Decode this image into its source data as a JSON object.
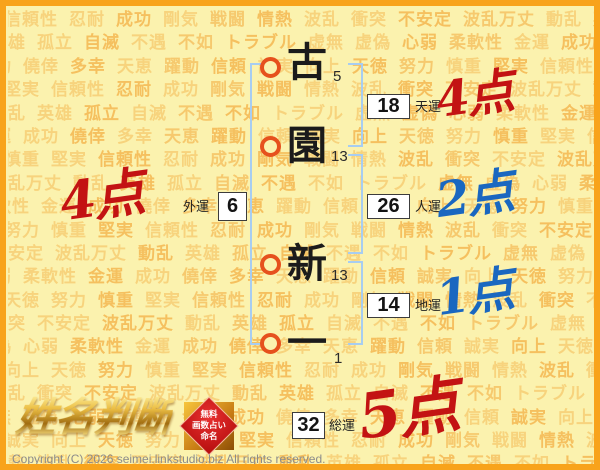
{
  "page": {
    "logo_text": "姓名判断",
    "copyright": "Copyright (C) 2026 seimei.linkstudio.biz All rights reserved.",
    "badge": {
      "line1": "無料",
      "line2": "画数占い",
      "line3": "命名"
    }
  },
  "name": {
    "characters": [
      {
        "char": "古",
        "strokes": "5"
      },
      {
        "char": "園",
        "strokes": "13"
      },
      {
        "char": "新",
        "strokes": "13"
      },
      {
        "char": "一",
        "strokes": "1"
      }
    ]
  },
  "fortunes": [
    {
      "id": "tenun",
      "label": "天運",
      "value": "18",
      "score": "4点",
      "score_color": "#c31313"
    },
    {
      "id": "jinun",
      "label": "人運",
      "value": "26",
      "score": "2点",
      "score_color": "#1a67c0"
    },
    {
      "id": "chiun",
      "label": "地運",
      "value": "14",
      "score": "1点",
      "score_color": "#1a67c0"
    },
    {
      "id": "gaiun",
      "label": "外運",
      "value": "6",
      "score": "4点",
      "score_color": "#c31313"
    },
    {
      "id": "souun",
      "label": "総運",
      "value": "32",
      "score": "5点",
      "score_color": "#c31313"
    }
  ],
  "colors": {
    "border": "#f8a31b",
    "background": "#fbf2ae",
    "watermark_word": "#f3a93a",
    "bracket_blue": "#a7cdf1",
    "circle_red": "#e6511d",
    "score_red": "#c31313",
    "score_blue": "#1a67c0"
  },
  "background_words": [
    "信頼性",
    "忍耐",
    "成功",
    "剛気",
    "戦闘",
    "情熱",
    "波乱",
    "衝突",
    "不安定",
    "波乱万丈",
    "動乱",
    "英雄",
    "孤立",
    "自滅",
    "不遇",
    "不如",
    "トラブル",
    "虚無",
    "虚偽",
    "心弱",
    "柔軟性",
    "金運",
    "成功",
    "僥倖",
    "多幸",
    "天恵",
    "躍動",
    "信頼",
    "誠実",
    "向上",
    "天徳",
    "努力",
    "慎重",
    "堅実"
  ]
}
